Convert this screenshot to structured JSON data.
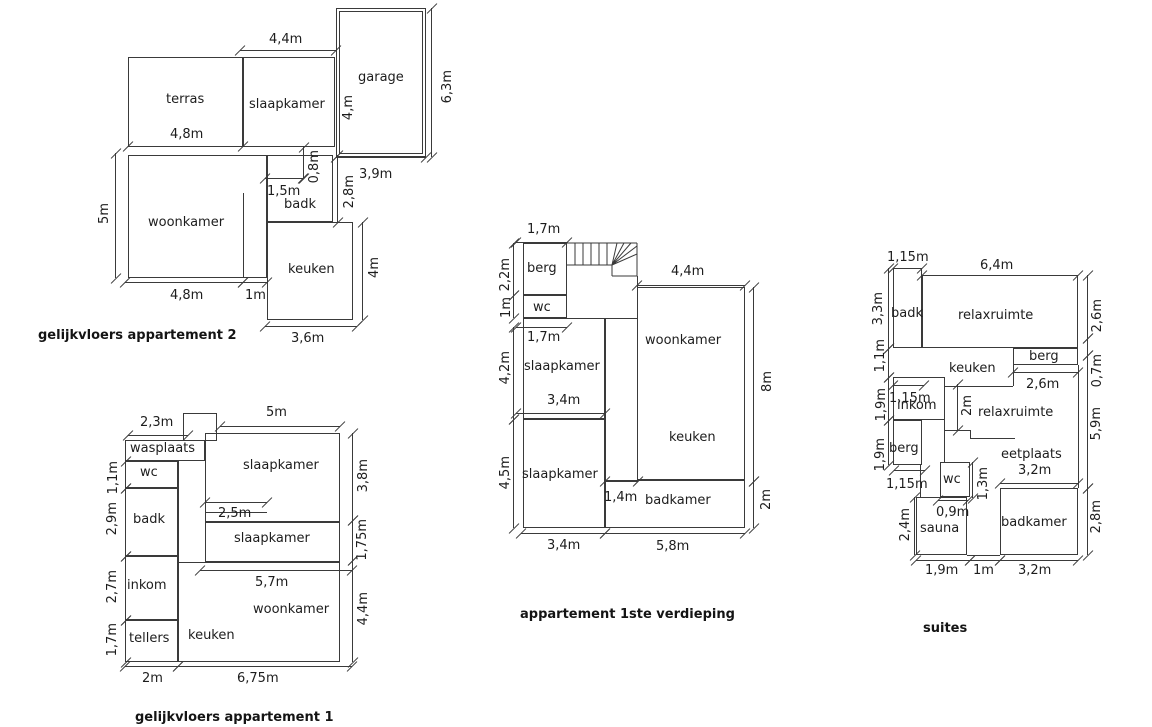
{
  "plans": [
    {
      "caption": "gelijkvloers appartement 2",
      "rooms": [
        "terras",
        "slaapkamer",
        "garage",
        "woonkamer",
        "badk",
        "keuken"
      ],
      "dims": [
        "4,4m",
        "4,8m",
        "6,3m",
        "4,m",
        "3,9m",
        "0,8m",
        "1,5m",
        "2,8m",
        "5m",
        "4,8m",
        "1m",
        "4m",
        "3,6m"
      ]
    },
    {
      "caption": "gelijkvloers appartement 1",
      "rooms": [
        "wasplaats",
        "wc",
        "badk",
        "inkom",
        "tellers",
        "slaapkamer",
        "slaapkamer",
        "keuken",
        "woonkamer"
      ],
      "dims": [
        "2,3m",
        "5m",
        "1,1m",
        "2,9m",
        "2,7m",
        "1,7m",
        "3,8m",
        "1,75m",
        "4,4m",
        "2,5m",
        "5,7m",
        "2m",
        "6,75m"
      ]
    },
    {
      "caption": "appartement 1ste verdieping",
      "rooms": [
        "berg",
        "wc",
        "slaapkamer",
        "slaapkamer",
        "woonkamer",
        "keuken",
        "badkamer"
      ],
      "dims": [
        "1,7m",
        "2,2m",
        "1m",
        "1,7m",
        "4,2m",
        "3,4m",
        "4,5m",
        "4,4m",
        "8m",
        "2m",
        "1,4m",
        "3,4m",
        "5,8m"
      ]
    },
    {
      "caption": "suites",
      "rooms": [
        "badk",
        "relaxruimte",
        "berg",
        "keuken",
        "inkom",
        "berg",
        "relaxruimte",
        "eetplaats",
        "wc",
        "sauna",
        "badkamer"
      ],
      "dims": [
        "1,15m",
        "6,4m",
        "3,3m",
        "1,1m",
        "1,9m",
        "1,9m",
        "1,15m",
        "2m",
        "2,6m",
        "1,15m",
        "1,3m",
        "0,9m",
        "3,2m",
        "2,4m",
        "2,6m",
        "0,7m",
        "5,9m",
        "2,8m",
        "1,9m",
        "1m",
        "3,2m"
      ]
    }
  ]
}
